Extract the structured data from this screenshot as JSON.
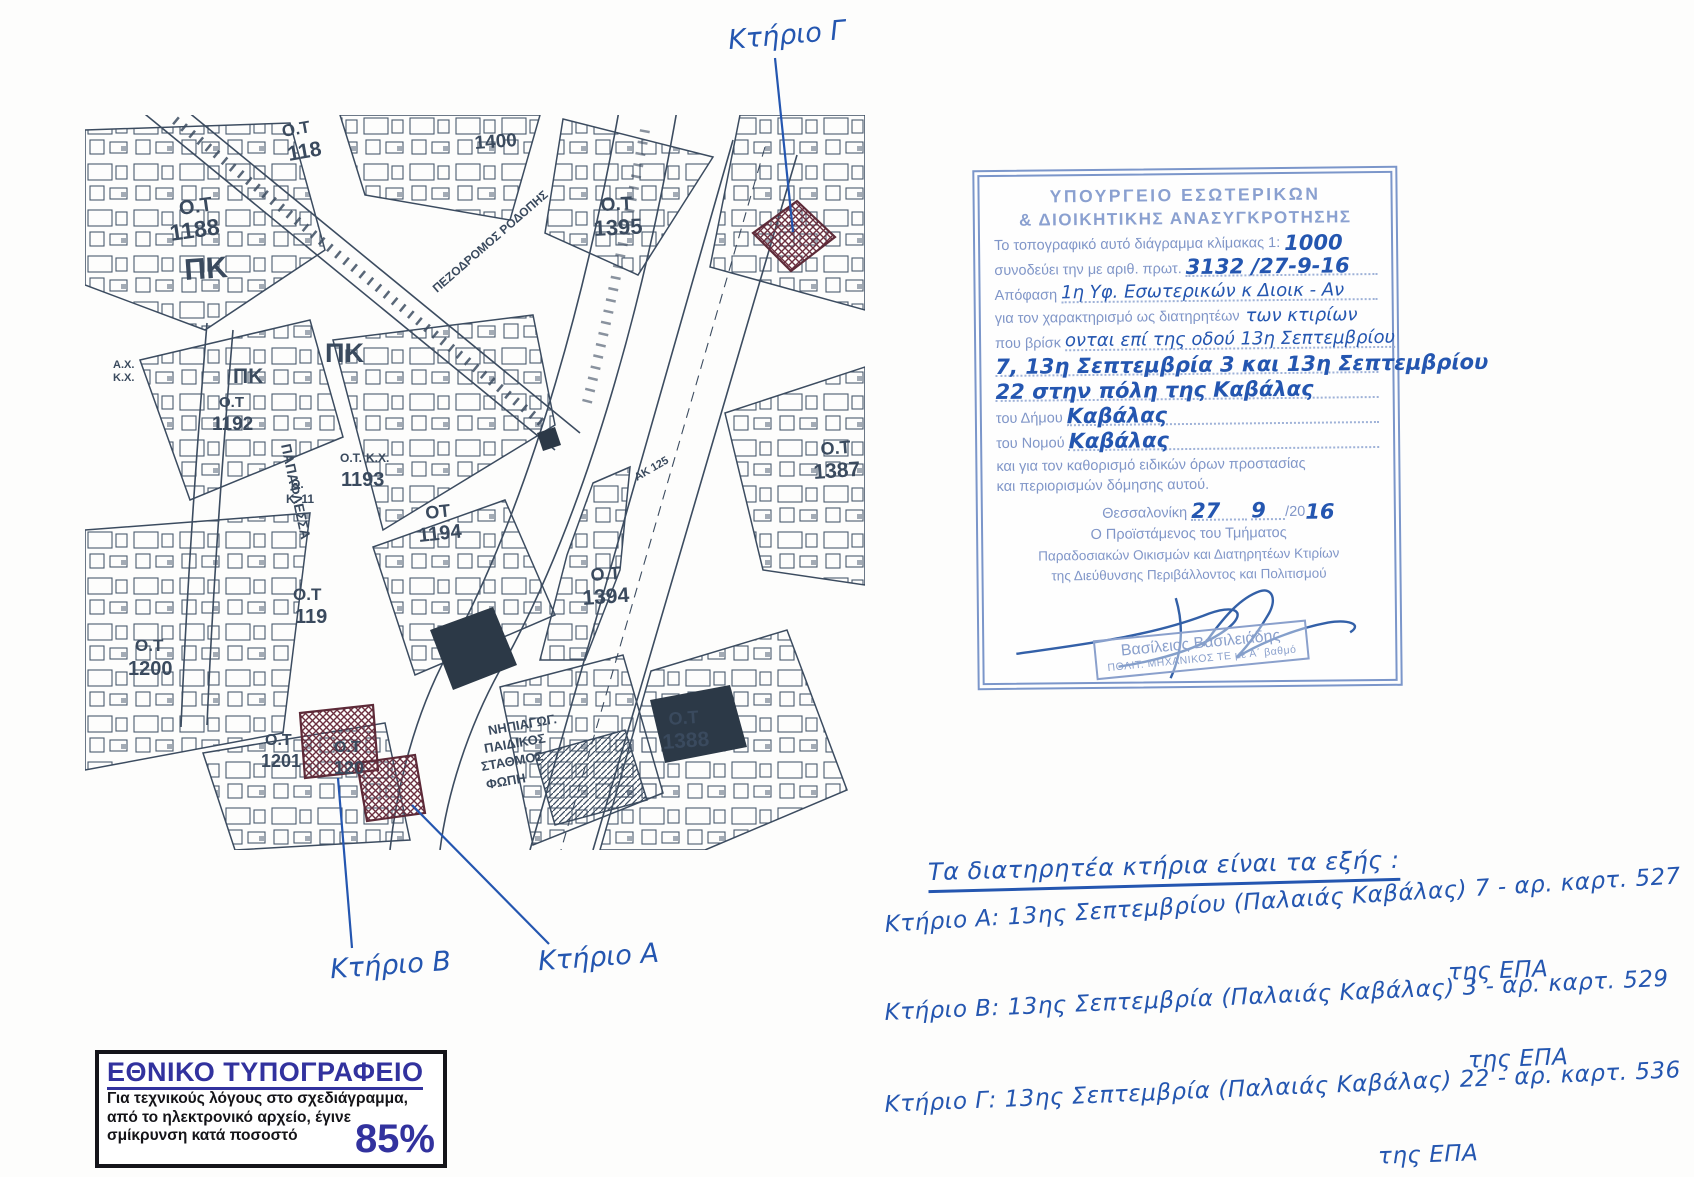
{
  "colors": {
    "map_ink": "#3a4a5e",
    "hand_blue": "#2456b0",
    "stamp_blue": "#8096c8",
    "hatch_maroon": "#6b2f3f",
    "press_blue": "#32329e"
  },
  "map": {
    "handwritten_labels": {
      "gamma": "Κτήριο Γ",
      "beta": "Κτήριο Β",
      "alpha": "Κτήριο Α"
    },
    "labels": [
      {
        "t": "Ο.Τ",
        "x": 95,
        "y": 100,
        "s": 20,
        "r": -8
      },
      {
        "t": "1188",
        "x": 86,
        "y": 126,
        "s": 23,
        "r": -8
      },
      {
        "t": "ΠΚ",
        "x": 100,
        "y": 165,
        "s": 30,
        "r": -4,
        "b": 1
      },
      {
        "t": "Ο.Τ",
        "x": 198,
        "y": 22,
        "s": 17,
        "r": -10
      },
      {
        "t": "118",
        "x": 204,
        "y": 46,
        "s": 21,
        "r": -10
      },
      {
        "t": "1400",
        "x": 390,
        "y": 34,
        "s": 19,
        "r": -4
      },
      {
        "t": "Ο.Τ",
        "x": 516,
        "y": 96,
        "s": 19,
        "r": -3
      },
      {
        "t": "1395",
        "x": 509,
        "y": 121,
        "s": 22,
        "r": -3
      },
      {
        "t": "ΠΚ",
        "x": 148,
        "y": 268,
        "s": 21,
        "r": 0,
        "b": 1
      },
      {
        "t": "Ο.Τ",
        "x": 134,
        "y": 292,
        "s": 15,
        "r": 0
      },
      {
        "t": "1192",
        "x": 127,
        "y": 315,
        "s": 19,
        "r": 0
      },
      {
        "t": "ΠΚ",
        "x": 240,
        "y": 247,
        "s": 27,
        "r": 0,
        "b": 1
      },
      {
        "t": "Α.Χ.",
        "x": 28,
        "y": 253,
        "s": 11,
        "r": 0
      },
      {
        "t": "Κ.Χ.",
        "x": 28,
        "y": 266,
        "s": 11,
        "r": 0
      },
      {
        "t": "Θ.",
        "x": 206,
        "y": 373,
        "s": 12,
        "r": 0
      },
      {
        "t": "Κ. 11",
        "x": 201,
        "y": 388,
        "s": 12,
        "r": 0
      },
      {
        "t": "Ο.Τ.",
        "x": 255,
        "y": 347,
        "s": 12,
        "r": 0
      },
      {
        "t": "Κ.Χ.",
        "x": 281,
        "y": 347,
        "s": 12,
        "r": 0
      },
      {
        "t": "1193",
        "x": 256,
        "y": 371,
        "s": 20,
        "r": 0
      },
      {
        "t": "ΟΤ",
        "x": 341,
        "y": 404,
        "s": 18,
        "r": -6
      },
      {
        "t": "1194",
        "x": 334,
        "y": 427,
        "s": 20,
        "r": -6
      },
      {
        "t": "Ο.Τ",
        "x": 208,
        "y": 485,
        "s": 17,
        "r": 0
      },
      {
        "t": "119",
        "x": 210,
        "y": 508,
        "s": 20,
        "r": 0
      },
      {
        "t": "Ο.Τ",
        "x": 50,
        "y": 536,
        "s": 17,
        "r": 0
      },
      {
        "t": "1200",
        "x": 43,
        "y": 560,
        "s": 20,
        "r": 0
      },
      {
        "t": "Ο.Τ",
        "x": 180,
        "y": 630,
        "s": 16,
        "r": 0
      },
      {
        "t": "1201",
        "x": 176,
        "y": 652,
        "s": 18,
        "r": 0
      },
      {
        "t": "Ο.Τ",
        "x": 249,
        "y": 637,
        "s": 16,
        "r": 0
      },
      {
        "t": "120",
        "x": 249,
        "y": 659,
        "s": 18,
        "r": 0
      },
      {
        "t": "Ο.Τ",
        "x": 506,
        "y": 466,
        "s": 18,
        "r": -4
      },
      {
        "t": "1394",
        "x": 498,
        "y": 490,
        "s": 21,
        "r": -4
      },
      {
        "t": "Ο.Τ",
        "x": 736,
        "y": 340,
        "s": 18,
        "r": -4
      },
      {
        "t": "1387",
        "x": 729,
        "y": 364,
        "s": 21,
        "r": -4
      },
      {
        "t": "ΑΚ 125",
        "x": 552,
        "y": 366,
        "s": 11,
        "r": -30
      },
      {
        "t": "Ο.Τ",
        "x": 584,
        "y": 610,
        "s": 18,
        "r": -4
      },
      {
        "t": "1388",
        "x": 578,
        "y": 634,
        "s": 21,
        "r": -4
      },
      {
        "t": "ΝΗΠΙΑΓΩΓ.",
        "x": 404,
        "y": 620,
        "s": 13,
        "r": -10,
        "b": 1
      },
      {
        "t": "ΠΑΙΔΙΚΟΣ",
        "x": 400,
        "y": 638,
        "s": 13,
        "r": -10,
        "b": 1
      },
      {
        "t": "ΣΤΑΘΜΟΣ",
        "x": 397,
        "y": 656,
        "s": 13,
        "r": -10,
        "b": 1
      },
      {
        "t": "ΦΩΠΗ",
        "x": 402,
        "y": 674,
        "s": 13,
        "r": -10,
        "b": 1
      },
      {
        "t": "ΠΑΠΑΦΛΕΣΣΑ",
        "x": 196,
        "y": 330,
        "s": 14,
        "r": 78
      },
      {
        "t": "ΠΕΖΟΔΡΟΜΟΣ  ΡΟΔΟΠΗΣ",
        "x": 352,
        "y": 178,
        "s": 12,
        "r": -41
      }
    ]
  },
  "stamp": {
    "header1": "ΥΠΟΥΡΓΕΙΟ ΕΣΩΤΕΡΙΚΩΝ",
    "header2": "& ΔΙΟΙΚΗΤΙΚΗΣ ΑΝΑΣΥΓΚΡΟΤΗΣΗΣ",
    "body1": "Το τοπογραφικό αυτό διάγραμμα κλίμακας 1:",
    "scale_hw": "1000",
    "body2": "συνοδεύει την με αριθ. πρωτ.",
    "protocol_hw": "3132 /27-9-16",
    "decision_label": "Απόφαση",
    "decision_hw": "1η Υφ. Εσωτερικών κ Διοικ - Αν",
    "body4": "για τον χαρακτηρισμό ως διατηρητέων",
    "body4_hw": "των κτιρίων",
    "body5": "που βρίσκ",
    "body5_hw": "ονται επί της οδού 13η Σεπτεμβρίου",
    "hw_line6": "7, 13η Σεπτεμβρία 3 και 13η Σεπτεμβρίου",
    "hw_line7": "22 στην πόλη της Καβάλας",
    "municipality_label": "του Δήμου",
    "municipality_hw": "Καβάλας",
    "prefecture_label": "του Νομού",
    "prefecture_hw": "Καβάλας",
    "body6": "και για τον καθορισμό ειδικών όρων προστασίας",
    "body7": "και περιορισμών δόμησης αυτού.",
    "city_label": "Θεσσαλονίκη",
    "date_day_hw": "27",
    "date_month_hw": "9",
    "date_year_prefix": "/20",
    "date_year_hw": "16",
    "sig_title1": "Ο Προϊστάμενος του Τμήματος",
    "sig_title2": "Παραδοσιακών Οικισμών και Διατηρητέων Κτιρίων",
    "sig_title3": "της Διεύθυνσης Περιβάλλοντος και Πολιτισμού",
    "sig_name": "Βασίλειος Βασιλειάδης",
    "sig_role": "ΠΟΛΙΤ. ΜΗΧΑΝΙΚΟΣ ΤΕ με Α΄ βαθμό"
  },
  "notes": {
    "header": "Τα διατηρητέα κτήρια είναι τα εξής :",
    "entries": [
      {
        "line": "Κτήριο Α:  13ης Σεπτεμβρίου (Παλαιάς Καβάλας) 7 - αρ. καρτ. 527",
        "line2": "της ΕΠΑ"
      },
      {
        "line": "Κτήριο Β:  13ης Σεπτεμβρία (Παλαιάς Καβάλας) 3 - αρ. καρτ. 529",
        "line2": "της ΕΠΑ"
      },
      {
        "line": "Κτήριο Γ:  13ης Σεπτεμβρία (Παλαιάς Καβάλας) 22 - αρ. καρτ. 536",
        "line2": "της ΕΠΑ"
      }
    ]
  },
  "press_box": {
    "title": "ΕΘΝΙΚΟ ΤΥΠΟΓΡΑΦΕΙΟ",
    "line1": "Για τεχνικούς λόγους στο σχεδιάγραμμα,",
    "line2": "από το ηλεκτρονικό αρχείο, έγινε",
    "line3": "σμίκρυνση κατά ποσοστό",
    "percent": "85%"
  }
}
